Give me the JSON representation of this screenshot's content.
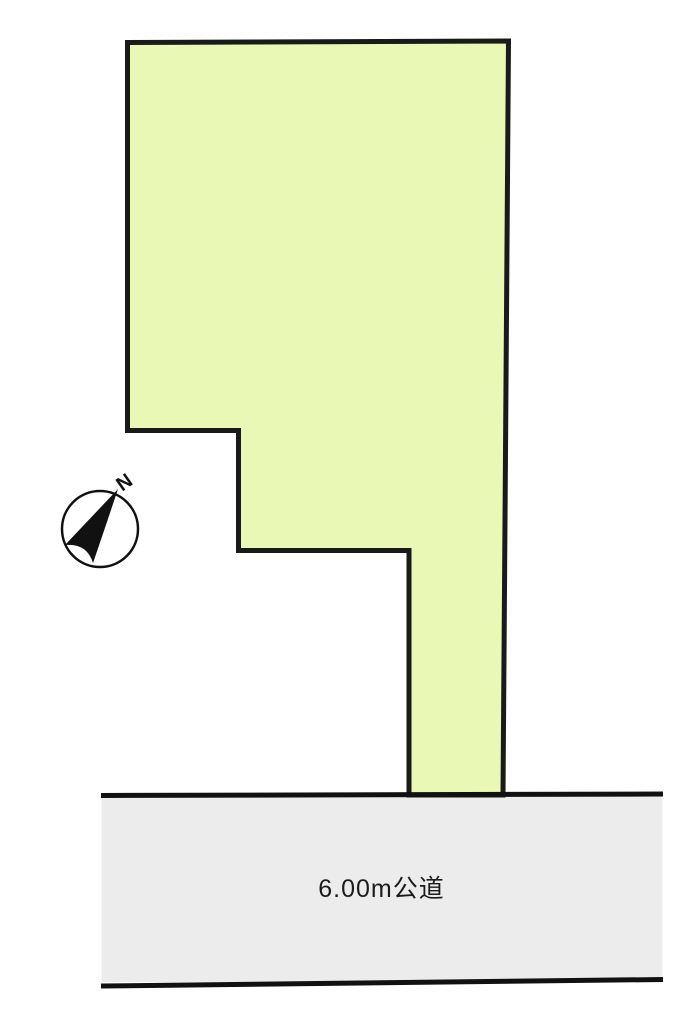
{
  "parcel": {
    "fill": "#e9f8b5",
    "outline_color": "#1a1a1a"
  },
  "road": {
    "label": "6.00m公道",
    "fill": "#ececec",
    "edge_color": "#111111"
  },
  "compass": {
    "label": "N",
    "color": "#111111"
  }
}
